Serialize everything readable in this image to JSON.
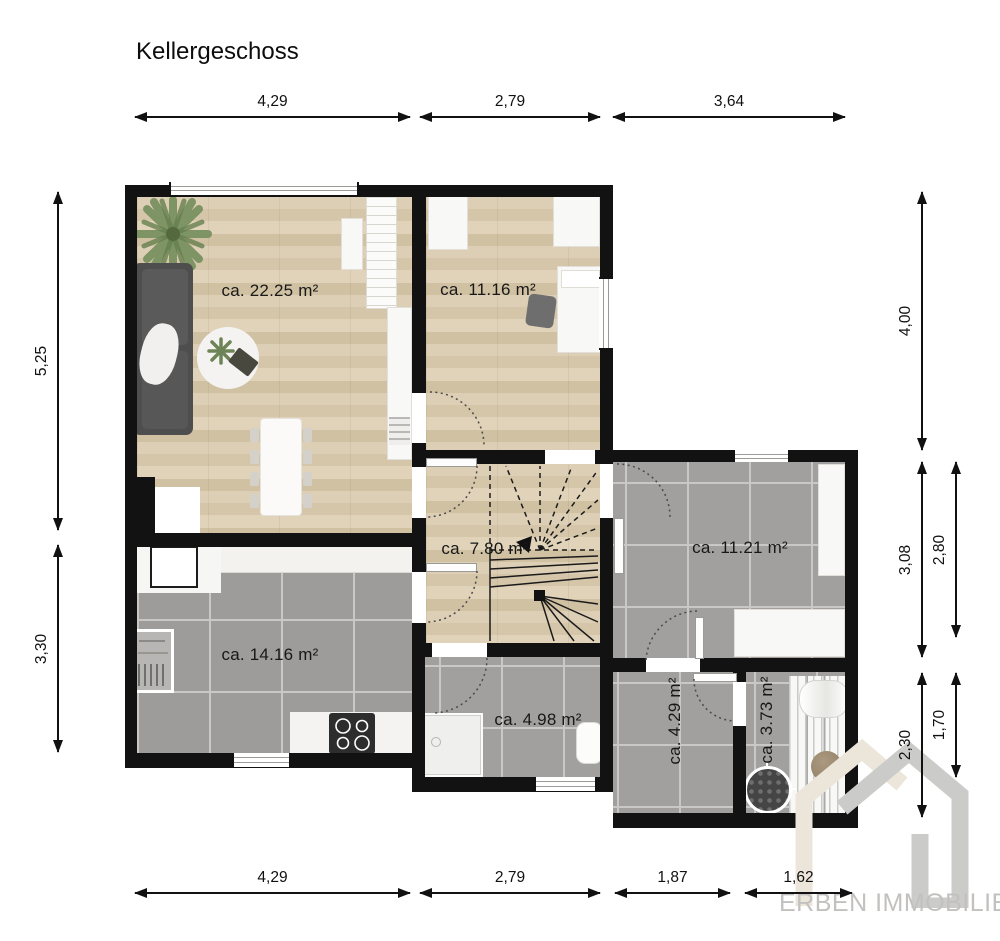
{
  "title": "Kellergeschoss",
  "rooms": {
    "living": {
      "label": "ca. 22.25 m²"
    },
    "bedroom": {
      "label": "ca. 11.16 m²"
    },
    "hall": {
      "label": "ca. 7.80 m²"
    },
    "storage": {
      "label": "ca. 11.21 m²"
    },
    "kitchen": {
      "label": "ca. 14.16 m²"
    },
    "bath": {
      "label": "ca. 4.98 m²"
    },
    "cellar": {
      "label": "ca. 4.29 m²"
    },
    "utility": {
      "label": "ca. 3.73 m²"
    }
  },
  "dimensions": {
    "top": [
      "4,29",
      "2,79",
      "3,64"
    ],
    "bottom": [
      "4,29",
      "2,79",
      "1,87",
      "1,62"
    ],
    "left": [
      "5,25",
      "3,30"
    ],
    "right_inner": [
      "4,00",
      "3,08",
      "2,30"
    ],
    "right_outer": [
      "2,80",
      "1,70"
    ]
  },
  "watermark": {
    "text": "ERBEN IMMOBILIEN"
  },
  "colors": {
    "wall": "#121212",
    "wood_floor": "#d9c9ae",
    "tile_floor": "#a1a09e",
    "watermark_gray": "#cbcbca",
    "watermark_beige": "#ece6da",
    "plant_green": "#7e9465"
  }
}
